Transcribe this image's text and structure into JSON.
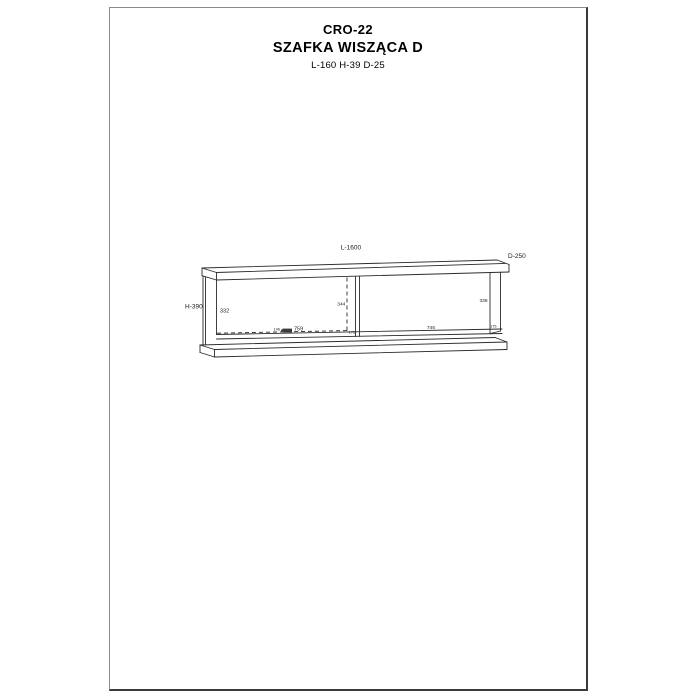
{
  "title": {
    "model": "CRO-22",
    "name": "SZAFKA WISZĄCA D",
    "dims": "L-160 H-39 D-25"
  },
  "drawing": {
    "labels": {
      "length": "L-1600",
      "depth": "D-250",
      "height": "H-390",
      "left_interior_height": "332",
      "left_door_height": "344",
      "right_interior_height": "338",
      "hinge_offset": "146",
      "left_compartment_width": "759",
      "right_compartment_width": "746",
      "divider_thickness": "175",
      "right_edge_thickness": "175"
    },
    "line_color": "#2b2b2b",
    "icons": [
      "hinge-icon"
    ]
  }
}
